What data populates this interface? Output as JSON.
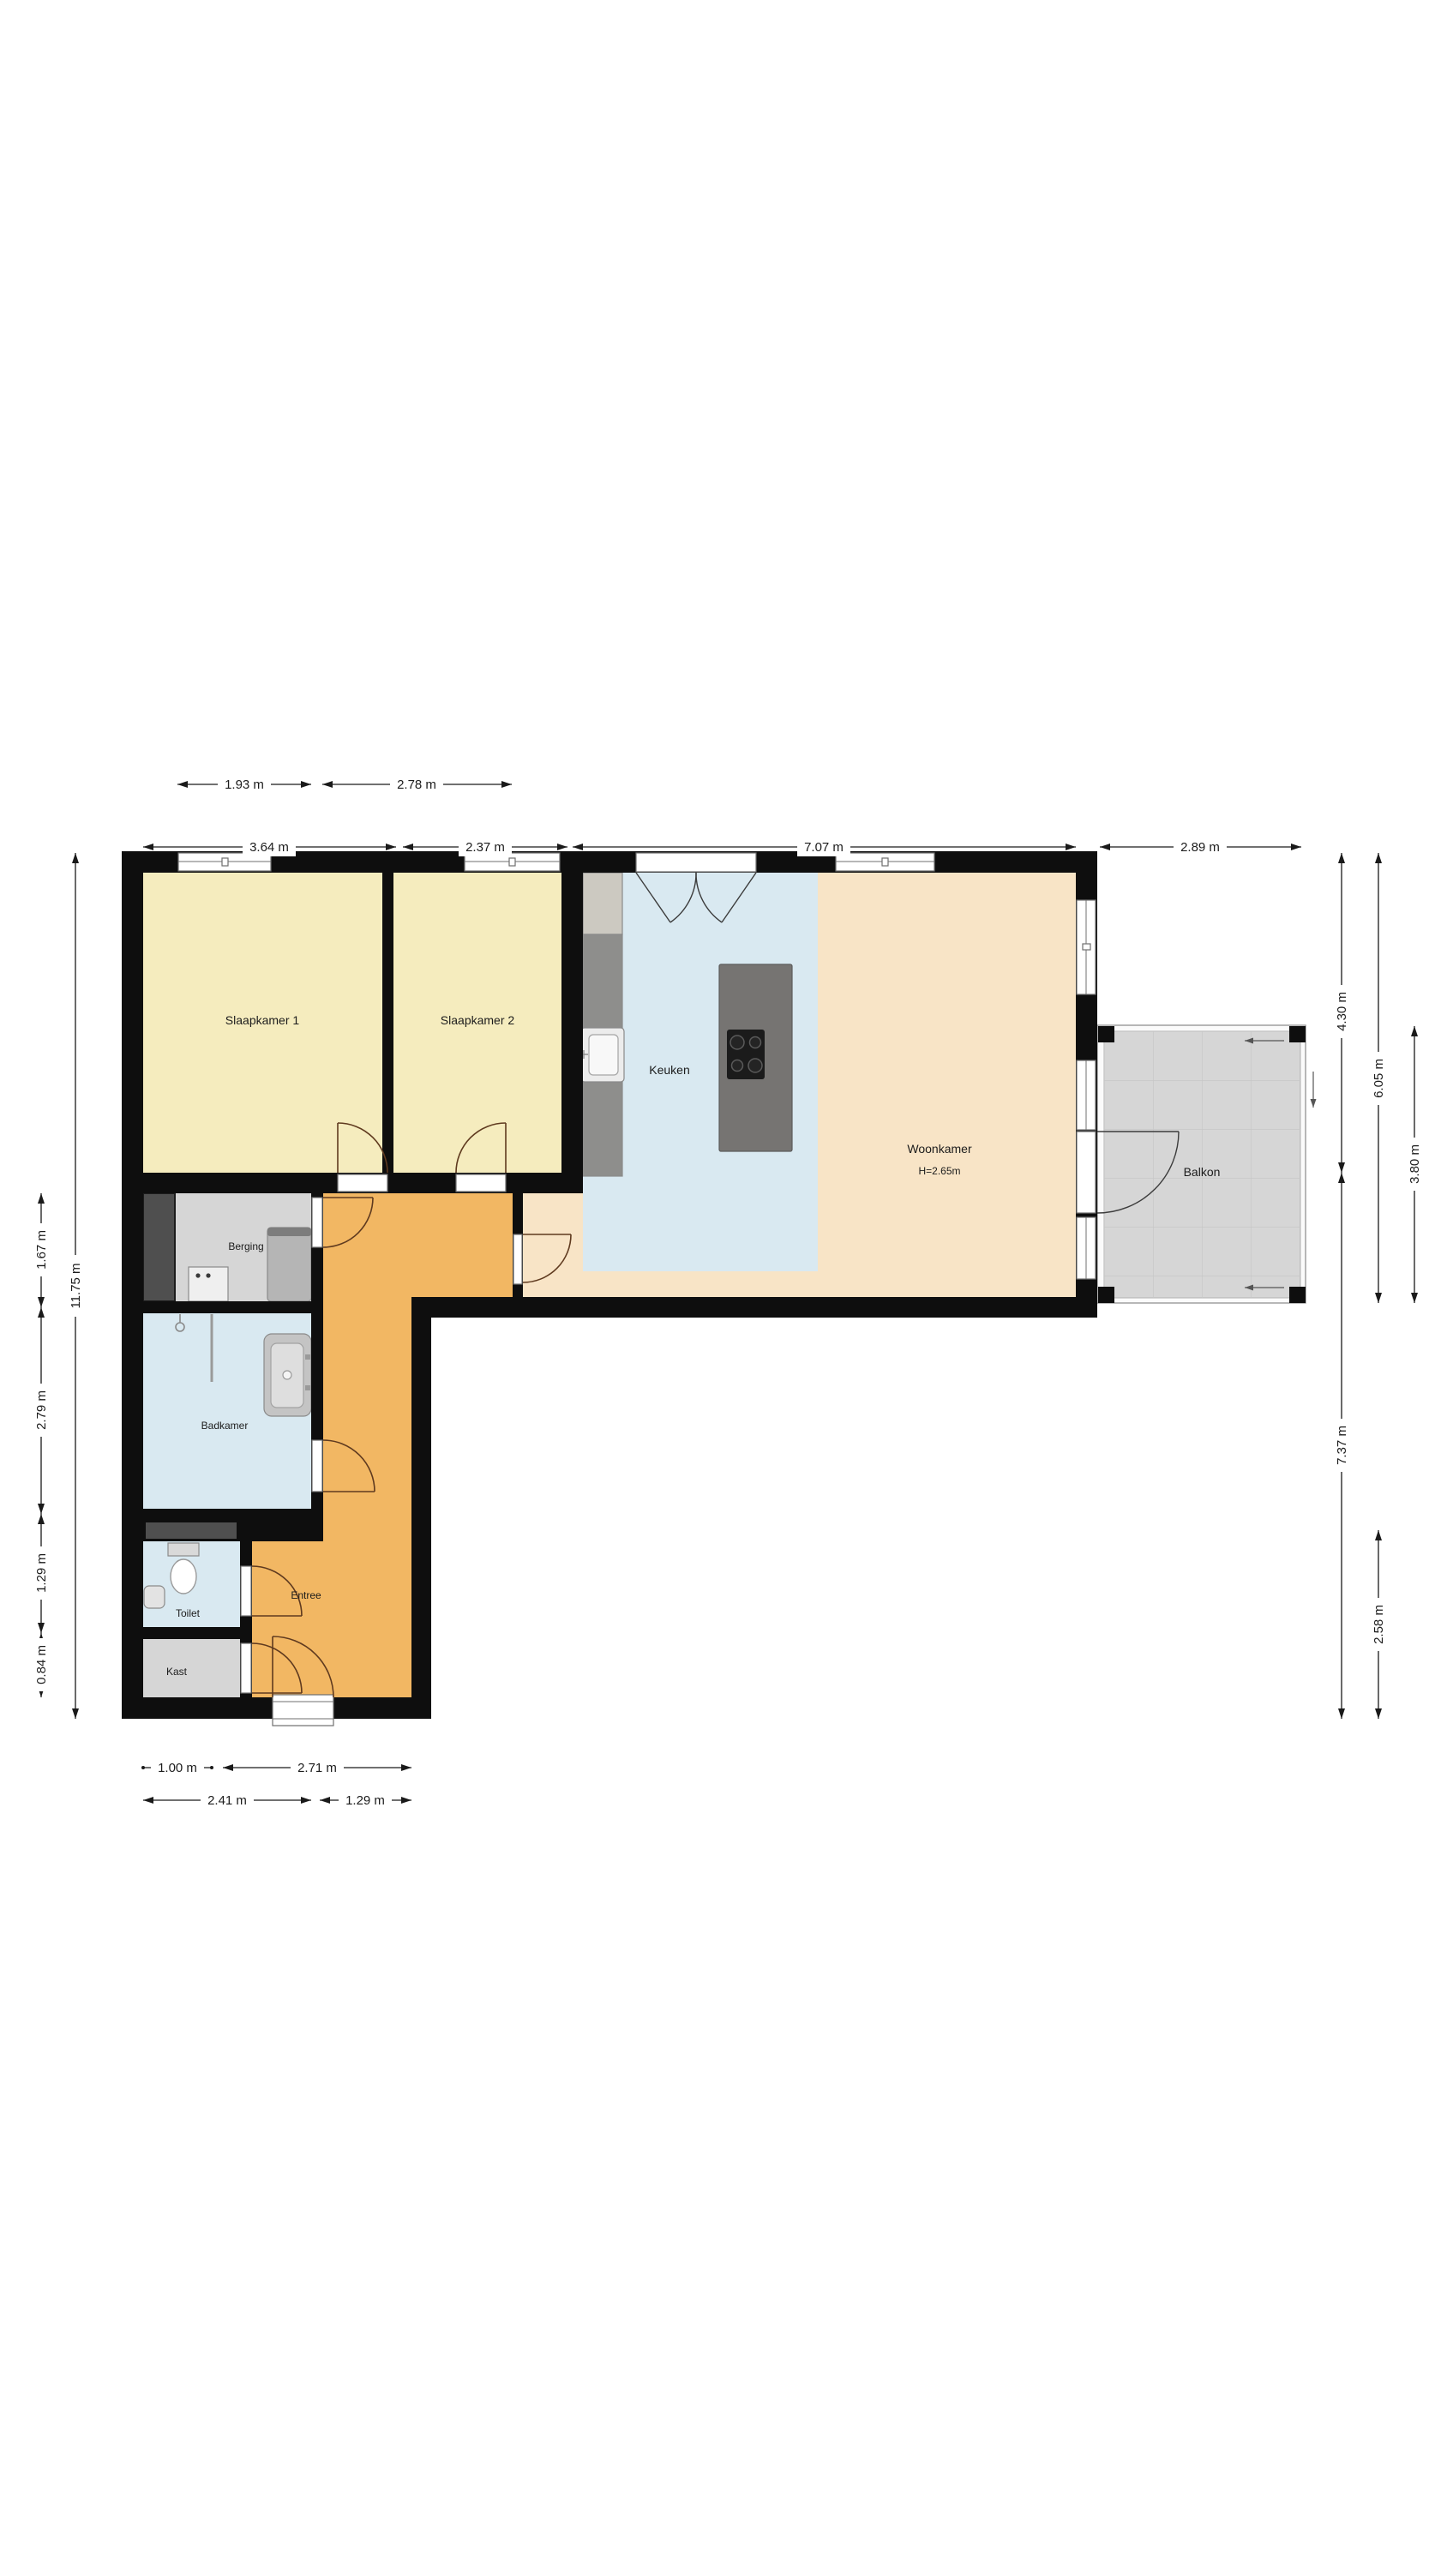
{
  "floorplan": {
    "rooms": [
      {
        "name": "Slaapkamer 1"
      },
      {
        "name": "Slaapkamer 2"
      },
      {
        "name": "Keuken"
      },
      {
        "name": "Woonkamer",
        "height_note": "H=2.65m"
      },
      {
        "name": "Balkon"
      },
      {
        "name": "Berging"
      },
      {
        "name": "Badkamer"
      },
      {
        "name": "Entree"
      },
      {
        "name": "Toilet"
      },
      {
        "name": "Kast"
      }
    ],
    "dimensions": {
      "top_upper": [
        "1.93 m",
        "2.78 m"
      ],
      "top_lower": [
        "3.64 m",
        "2.37 m",
        "7.07 m",
        "2.89 m"
      ],
      "left_outer": "11.75 m",
      "left_inner": [
        "1.67 m",
        "2.79 m",
        "1.29 m",
        "0.84 m"
      ],
      "right_col1": [
        "4.30 m",
        "7.37 m"
      ],
      "right_col2": [
        "6.05 m",
        "2.58 m"
      ],
      "right_col3": [
        "3.80 m"
      ],
      "bottom_upper": [
        "1.00 m",
        "2.71 m"
      ],
      "bottom_lower": [
        "2.41 m",
        "1.29 m"
      ]
    },
    "colors": {
      "bedroom_floor": "#f5ecbe",
      "kitchen_floor": "#d9e9f1",
      "bathroom_floor": "#d9e9f1",
      "toilet_floor": "#d9e9f1",
      "living_floor": "#f8e4c6",
      "hallway_floor": "#f2b763",
      "storage_floor": "#d6d6d6",
      "closet_floor": "#d6d6d6",
      "balcony_floor": "#d6d6d6",
      "wall": "#0e0e0e"
    }
  }
}
